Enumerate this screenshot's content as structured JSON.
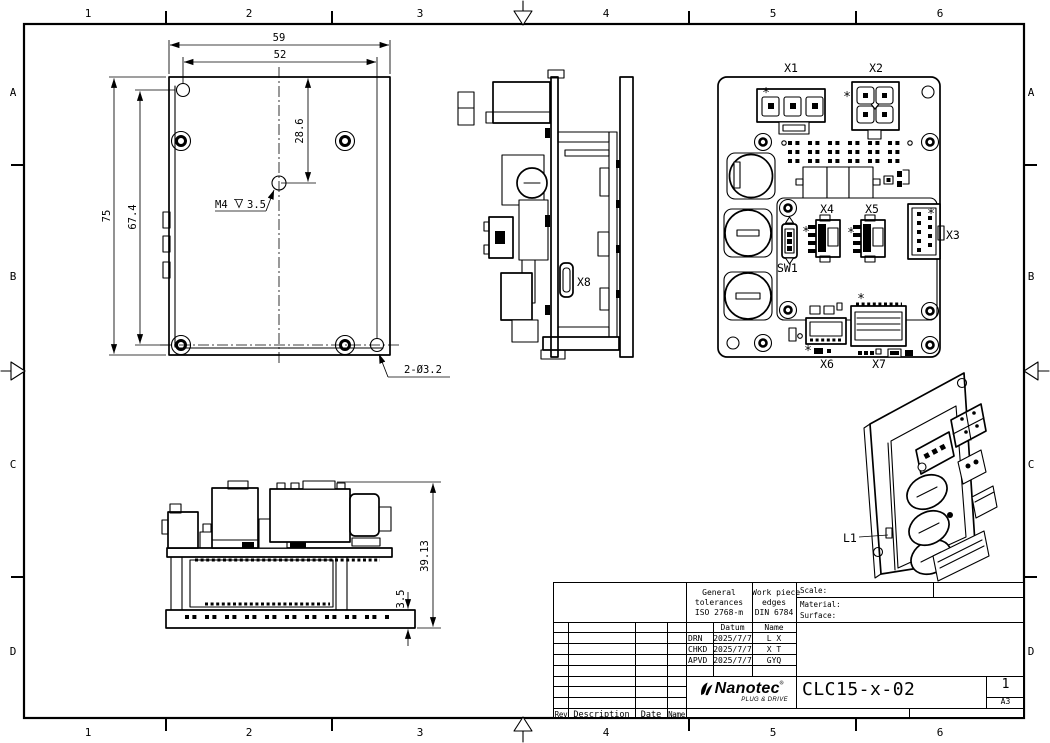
{
  "sheet": {
    "grid": {
      "columns": [
        "1",
        "2",
        "3",
        "4",
        "5",
        "6"
      ],
      "rows": [
        "A",
        "B",
        "C",
        "D"
      ]
    }
  },
  "views": {
    "front": {
      "dim_width_outer": "59",
      "dim_width_holes": "52",
      "dim_hole_offset": "28.6",
      "dim_height_outer": "75",
      "dim_height_holes": "67.4",
      "thread_callout_prefix": "M4",
      "thread_callout_depth": "3.5",
      "holes_callout": "2-Ø3.2"
    },
    "side": {
      "connector_x8": "X8"
    },
    "board": {
      "x1": "X1",
      "x2": "X2",
      "x3": "X3",
      "x4": "X4",
      "x5": "X5",
      "x6": "X6",
      "x7": "X7",
      "sw1": "SW1",
      "pin1_marker": "*"
    },
    "profile": {
      "dim_total_height": "39.13",
      "dim_plate_thickness": "3.5"
    },
    "iso": {
      "led_label": "L1"
    }
  },
  "title_block": {
    "tolerances_line1": "General",
    "tolerances_line2": "tolerances",
    "tolerances_line3": "ISO 2768-m",
    "edges_line1": "Work piece",
    "edges_line2": "edges",
    "edges_line3": "DIN 6784",
    "scale_label": "Scale:",
    "material_label": "Material:",
    "surface_label": "Surface:",
    "col_datum": "Datum",
    "col_name": "Name",
    "row_drn_label": "DRN",
    "row_drn_date": "2025/7/7",
    "row_drn_name": "L X",
    "row_chkd_label": "CHKD",
    "row_chkd_date": "2025/7/7",
    "row_chkd_name": "X T",
    "row_apvd_label": "APVD",
    "row_apvd_date": "2025/7/7",
    "row_apvd_name": "GYQ",
    "brand": "Nanotec",
    "brand_mark": "®",
    "brand_tagline": "PLUG & DRIVE",
    "part_number": "CLC15-x-02",
    "sheet_number": "1",
    "paper_format": "A3",
    "rev_label": "Rev",
    "description_label": "Description",
    "date_label": "Date",
    "name_label": "Name"
  }
}
